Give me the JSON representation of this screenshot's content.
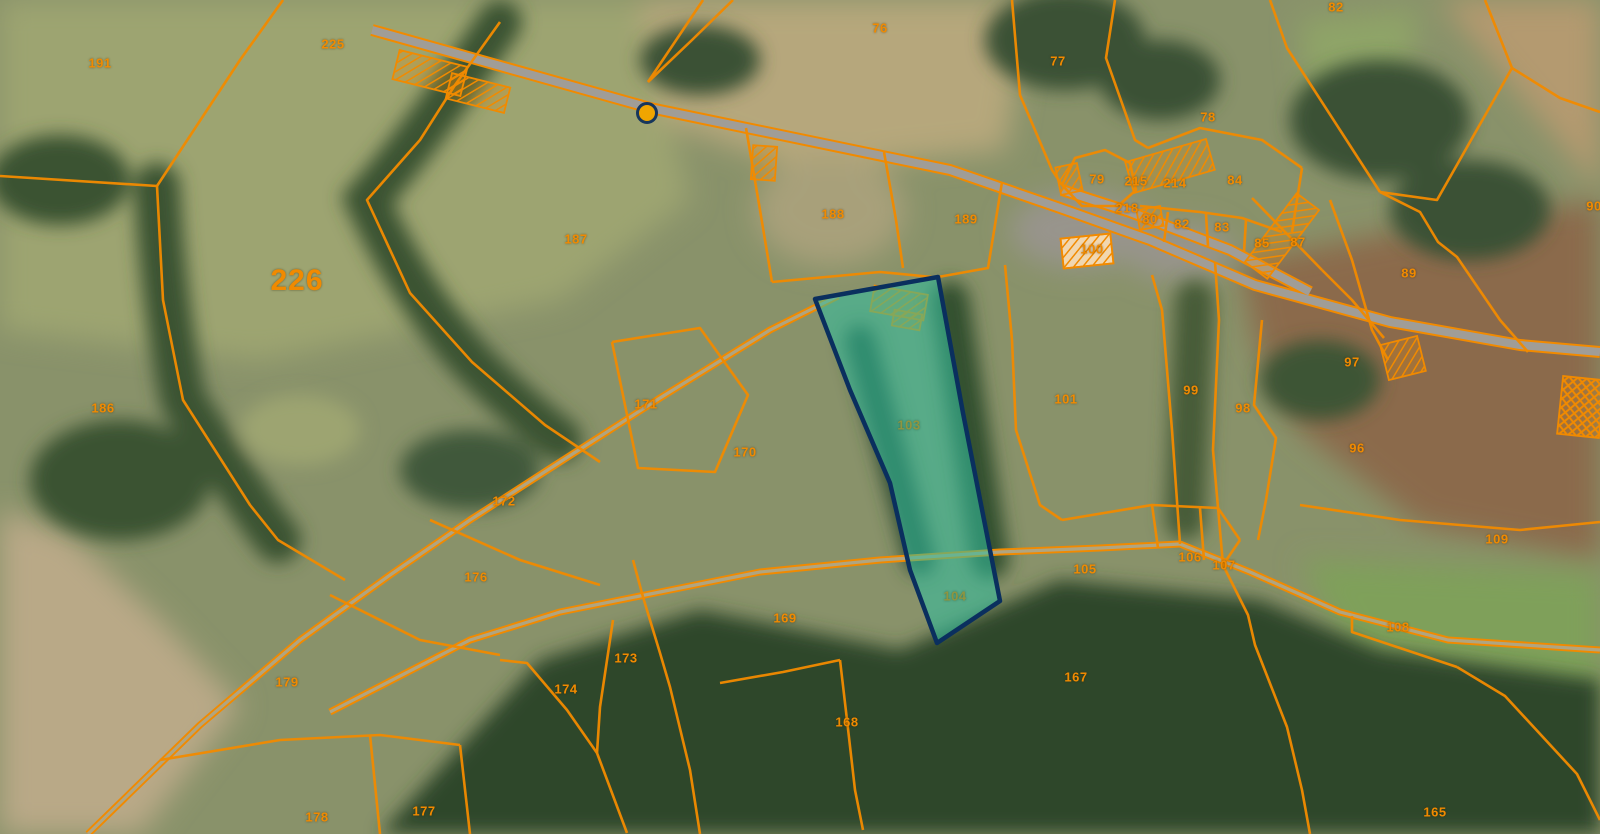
{
  "map": {
    "type": "cadastral-aerial-view",
    "colors": {
      "boundary": "#f18a00",
      "label": "#f18a00",
      "selection_fill": "#2fbfa0",
      "selection_border": "#0a2f5e",
      "selection_label": "#90953f",
      "road": "#a09d97",
      "marker_fill": "#f0a500",
      "marker_ring": "#16365c"
    },
    "marker": {
      "x": 647,
      "y": 113
    },
    "selected_parcel": {
      "labels": [
        "103",
        "104"
      ],
      "points": "815,299 938,277 963,413 1000,601 937,643 910,570 890,483 850,390"
    },
    "parcel_labels": [
      {
        "text": "191",
        "x": 100,
        "y": 63
      },
      {
        "text": "225",
        "x": 333,
        "y": 44
      },
      {
        "text": "226",
        "x": 297,
        "y": 281,
        "kind": "big"
      },
      {
        "text": "186",
        "x": 103,
        "y": 408
      },
      {
        "text": "76",
        "x": 880,
        "y": 28
      },
      {
        "text": "77",
        "x": 1058,
        "y": 61
      },
      {
        "text": "82",
        "x": 1336,
        "y": 7
      },
      {
        "text": "78",
        "x": 1208,
        "y": 117
      },
      {
        "text": "187",
        "x": 576,
        "y": 239
      },
      {
        "text": "188",
        "x": 833,
        "y": 214
      },
      {
        "text": "189",
        "x": 966,
        "y": 219
      },
      {
        "text": "79",
        "x": 1097,
        "y": 179
      },
      {
        "text": "215",
        "x": 1136,
        "y": 181
      },
      {
        "text": "214",
        "x": 1175,
        "y": 183
      },
      {
        "text": "84",
        "x": 1235,
        "y": 180
      },
      {
        "text": "218",
        "x": 1127,
        "y": 208
      },
      {
        "text": "80",
        "x": 1150,
        "y": 219
      },
      {
        "text": "82",
        "x": 1182,
        "y": 224
      },
      {
        "text": "83",
        "x": 1222,
        "y": 227
      },
      {
        "text": "85",
        "x": 1262,
        "y": 243
      },
      {
        "text": "87",
        "x": 1298,
        "y": 242
      },
      {
        "text": "100",
        "x": 1092,
        "y": 249
      },
      {
        "text": "90",
        "x": 1594,
        "y": 206
      },
      {
        "text": "89",
        "x": 1409,
        "y": 273
      },
      {
        "text": "97",
        "x": 1352,
        "y": 362
      },
      {
        "text": "101",
        "x": 1066,
        "y": 399
      },
      {
        "text": "99",
        "x": 1191,
        "y": 390
      },
      {
        "text": "98",
        "x": 1243,
        "y": 408
      },
      {
        "text": "96",
        "x": 1357,
        "y": 448
      },
      {
        "text": "109",
        "x": 1497,
        "y": 539
      },
      {
        "text": "105",
        "x": 1085,
        "y": 569
      },
      {
        "text": "106",
        "x": 1190,
        "y": 557
      },
      {
        "text": "107",
        "x": 1224,
        "y": 565
      },
      {
        "text": "108",
        "x": 1398,
        "y": 627
      },
      {
        "text": "167",
        "x": 1076,
        "y": 677
      },
      {
        "text": "165",
        "x": 1435,
        "y": 812
      },
      {
        "text": "171",
        "x": 646,
        "y": 404
      },
      {
        "text": "170",
        "x": 745,
        "y": 452
      },
      {
        "text": "172",
        "x": 504,
        "y": 501
      },
      {
        "text": "176",
        "x": 476,
        "y": 577
      },
      {
        "text": "179",
        "x": 287,
        "y": 682
      },
      {
        "text": "178",
        "x": 317,
        "y": 817
      },
      {
        "text": "177",
        "x": 424,
        "y": 811
      },
      {
        "text": "173",
        "x": 626,
        "y": 658
      },
      {
        "text": "174",
        "x": 566,
        "y": 689
      },
      {
        "text": "169",
        "x": 785,
        "y": 618
      },
      {
        "text": "168",
        "x": 847,
        "y": 722
      },
      {
        "text": "103",
        "x": 909,
        "y": 425,
        "kind": "sel"
      },
      {
        "text": "104",
        "x": 955,
        "y": 596,
        "kind": "sel"
      }
    ]
  }
}
